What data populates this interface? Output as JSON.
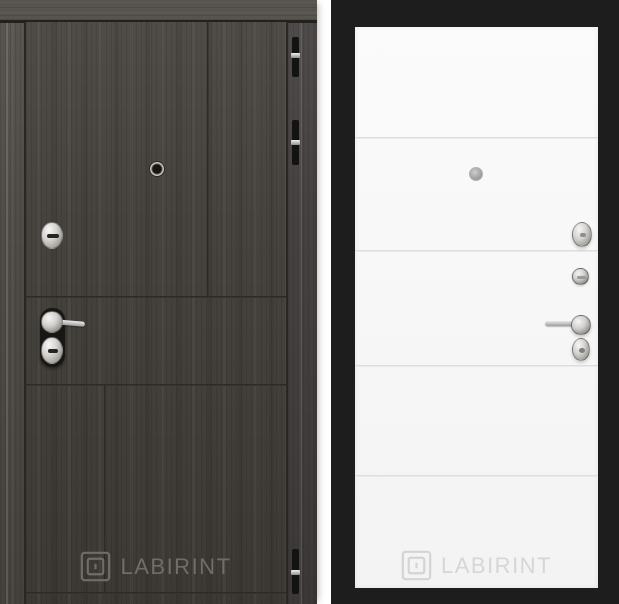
{
  "canvas": {
    "width": 619,
    "height": 604,
    "background": "#ffffff"
  },
  "brand": "LABIRINT",
  "left_door": {
    "description": "dark wenge wood entrance door panel",
    "watermark": "LABIRINT",
    "colors": {
      "wood_base": "#4b4742",
      "groove_line": "#2c2926",
      "watermark": "#706d68",
      "hinge": "#131313",
      "chrome": "#d2d0cd"
    },
    "hardware": [
      "peephole-icon",
      "lock-knob-icon",
      "lever-handle-icon",
      "keyhole-escutcheon-icon",
      "hinge-icon",
      "hinge-icon",
      "hinge-icon"
    ]
  },
  "right_door": {
    "description": "white door panel with horizontal moldings in black frame",
    "watermark": "LABIRINT",
    "colors": {
      "frame": "#1d1d1d",
      "leaf": "#f6f6f6",
      "groove_line": "#d7d7d7",
      "watermark": "#d6d6d6",
      "chrome": "#c9c9c9"
    },
    "hardware": [
      "peephole-icon",
      "thumbturn-icon",
      "cylinder-lock-icon",
      "lever-handle-icon",
      "keyhole-escutcheon-icon"
    ]
  }
}
